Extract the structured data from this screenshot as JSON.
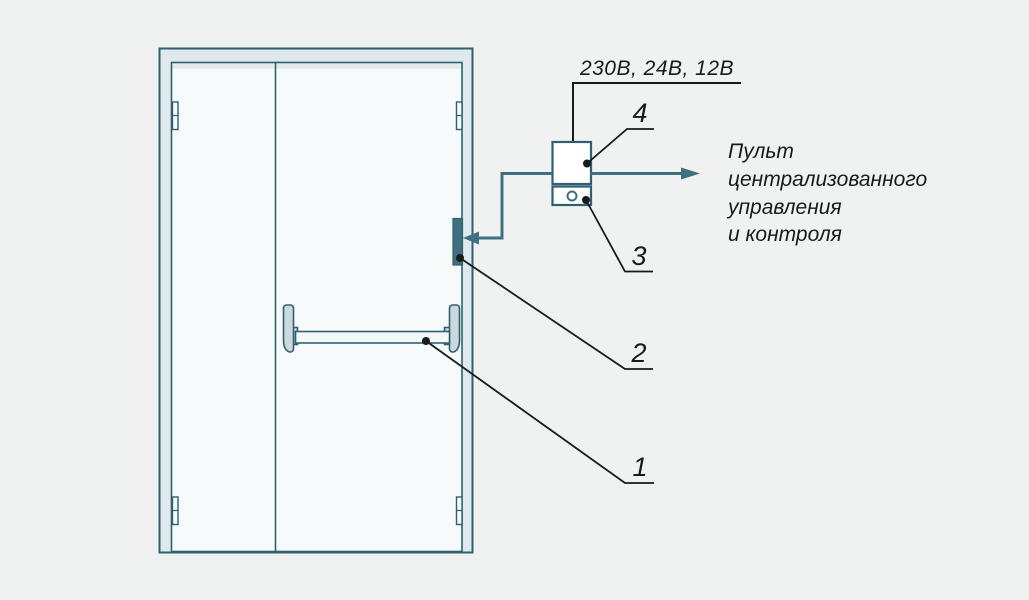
{
  "diagram": {
    "type": "technical-illustration",
    "subject": "emergency-exit-double-door-with-panic-bar-and-electric-lock-control",
    "labels": {
      "voltage": "230В, 24В, 12В",
      "callout_1": "1",
      "callout_2": "2",
      "callout_3": "3",
      "callout_4": "4"
    },
    "pcu": {
      "line_1": "Пульт",
      "line_2": "централизованного",
      "line_3": "управления",
      "line_4": "и контроля"
    }
  },
  "colors": {
    "background": "#f0f1f1",
    "outline_teal": "#2e6170",
    "wire_teal": "#3f7080",
    "frame_fill": "#dfe8ea",
    "leaf_fill": "#f6fafb",
    "hardware_fill": "#ccd8db",
    "bar_fill": "#f2f7f8",
    "strike_fill": "#3f7080",
    "line_black": "#1a1a1a"
  }
}
